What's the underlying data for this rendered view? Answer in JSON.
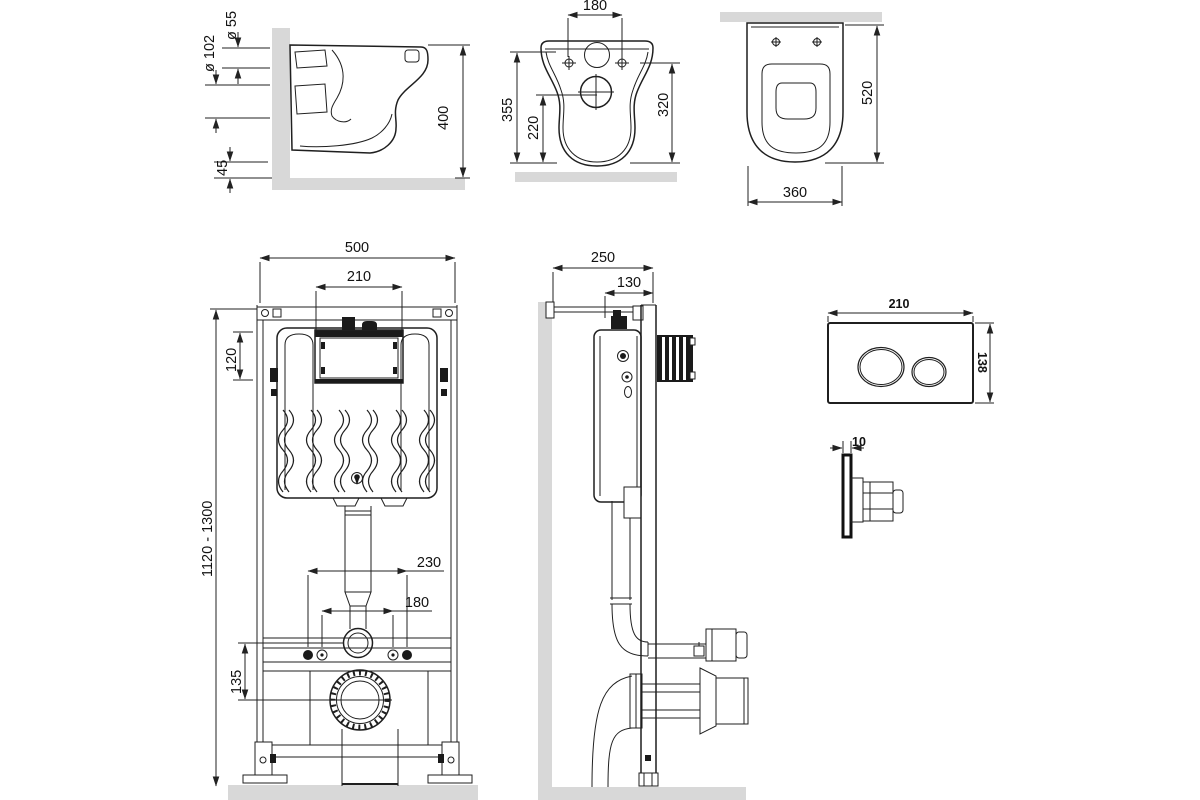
{
  "drawing_type": "wall-hung toilet installation technical drawing",
  "colors": {
    "background": "#ffffff",
    "line": "#1f1f1f",
    "wall_fill": "#d8d8d8",
    "text": "#111111"
  },
  "views": {
    "toilet_side": {
      "dims": {
        "inlet_diameter": "ø 55",
        "outlet_diameter": "ø 102",
        "rim_to_floor": "45",
        "height": "400"
      }
    },
    "toilet_back": {
      "dims": {
        "bolt_spacing": "180",
        "height_total": "355",
        "outlet_height": "220",
        "bolt_height": "320"
      }
    },
    "toilet_top": {
      "dims": {
        "depth": "520",
        "width": "360"
      }
    },
    "frame_front": {
      "dims": {
        "width": "500",
        "window_width": "210",
        "window_height": "120",
        "height_range": "1120 - 1300",
        "stud_spacing_outer": "230",
        "stud_spacing_inner": "180",
        "flush_to_outlet": "135"
      }
    },
    "frame_side": {
      "dims": {
        "depth_total": "250",
        "depth_frame": "130"
      }
    },
    "flush_plate_front": {
      "dims": {
        "width": "210",
        "height": "138"
      }
    },
    "flush_plate_side": {
      "dims": {
        "thickness": "10"
      }
    }
  }
}
